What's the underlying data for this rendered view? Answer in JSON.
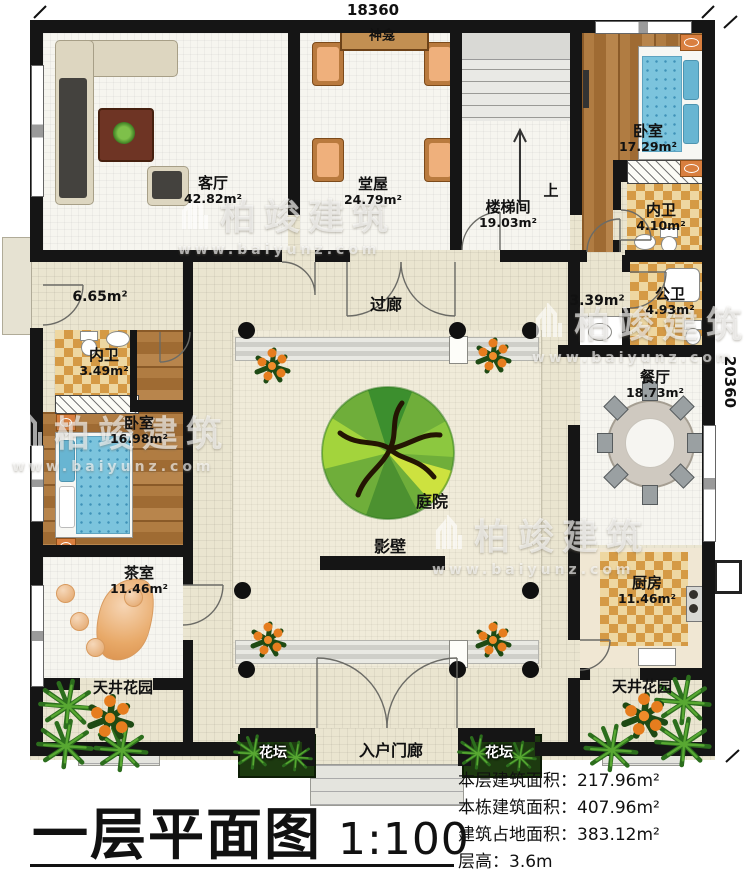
{
  "dimensions": {
    "top": "18360",
    "right": "20360"
  },
  "watermark": {
    "brand": "柏竣建筑",
    "url": "www.baiyunz.com"
  },
  "rooms": {
    "living": {
      "name": "客厅",
      "area": "42.82m²"
    },
    "shrine": {
      "name": "神龛"
    },
    "hall": {
      "name": "堂屋",
      "area": "24.79m²"
    },
    "stairwell": {
      "name": "楼梯间",
      "area": "19.03m²"
    },
    "stair_up": {
      "name": "上"
    },
    "bedroom_ne": {
      "name": "卧室",
      "area": "17.29m²"
    },
    "bath_ne": {
      "name": "内卫",
      "area": "4.10m²"
    },
    "wash_area": {
      "area": "3.39m²"
    },
    "public_bath": {
      "name": "公卫",
      "area": "4.93m²"
    },
    "corridor": {
      "name": "过廊"
    },
    "entry_w": {
      "area": "6.65m²"
    },
    "bath_w": {
      "name": "内卫",
      "area": "3.49m²"
    },
    "bedroom_w": {
      "name": "卧室",
      "area": "16.98m²"
    },
    "dining": {
      "name": "餐厅",
      "area": "18.73m²"
    },
    "courtyard": {
      "name": "庭院"
    },
    "screen_wall": {
      "name": "影壁"
    },
    "tea": {
      "name": "茶室",
      "area": "11.46m²"
    },
    "kitchen": {
      "name": "厨房",
      "area": "11.46m²"
    },
    "patio_sw": {
      "name": "天井花园"
    },
    "patio_se": {
      "name": "天井花园"
    },
    "flowerbed_w": {
      "name": "花坛"
    },
    "flowerbed_e": {
      "name": "花坛"
    },
    "porch": {
      "name": "入户门廊"
    }
  },
  "title_block": {
    "title": "一层平面图",
    "scale": "1:100",
    "stats": [
      {
        "label": "本层建筑面积：",
        "value": "217.96m²"
      },
      {
        "label": "本栋建筑面积：",
        "value": "407.96m²"
      },
      {
        "label": "建筑占地面积：",
        "value": "383.12m²"
      },
      {
        "label": "层高：",
        "value": "3.6m"
      }
    ]
  }
}
